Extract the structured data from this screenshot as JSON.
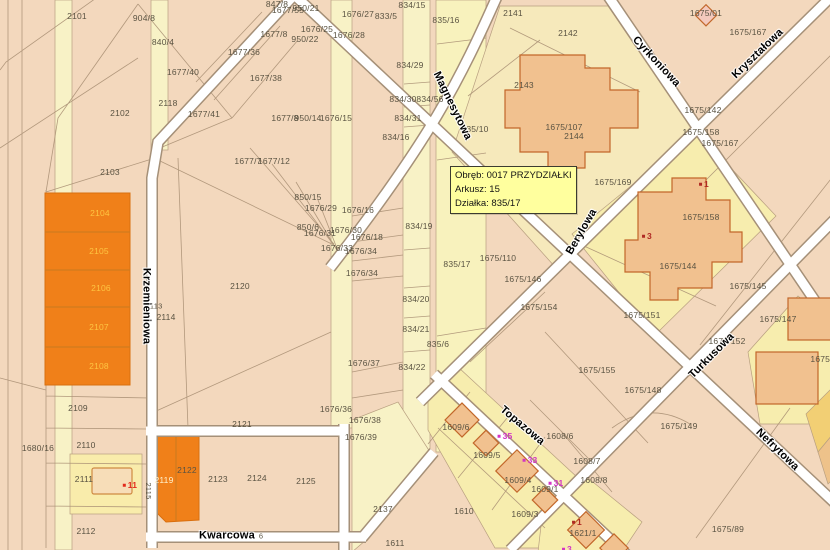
{
  "map": {
    "info_box": {
      "lines": [
        "Obręb: 0017 PRZYDZIAŁKI",
        "Arkusz: 15",
        "Działka: 835/17"
      ]
    },
    "colors": {
      "base": "#f3d8bd",
      "strip_yellow": "#f8f2c6",
      "parcel_yellow": "#f7edae",
      "orange": "#f08019",
      "street": "#ffffff",
      "building": "#f1c18f",
      "highlight_box": "#ffff9e"
    },
    "streets": [
      {
        "name": "Krzemieniowa",
        "x": 146,
        "y": 306,
        "rot": 90
      },
      {
        "name": "Kwarcowa",
        "x": 227,
        "y": 536,
        "rot": 0
      },
      {
        "name": "Magnesytowa",
        "x": 452,
        "y": 106,
        "rot": 64
      },
      {
        "name": "Cyrkoniowa",
        "x": 656,
        "y": 62,
        "rot": 47
      },
      {
        "name": "Kryształowa",
        "x": 758,
        "y": 54,
        "rot": -44
      },
      {
        "name": "Berylowa",
        "x": 582,
        "y": 232,
        "rot": -60
      },
      {
        "name": "Turkusowa",
        "x": 712,
        "y": 356,
        "rot": -45
      },
      {
        "name": "Topazowa",
        "x": 522,
        "y": 426,
        "rot": 40
      },
      {
        "name": "Nefrytowa",
        "x": 777,
        "y": 450,
        "rot": 44
      }
    ],
    "parcels": [
      {
        "t": "2101",
        "x": 77,
        "y": 16
      },
      {
        "t": "904/8",
        "x": 144,
        "y": 18
      },
      {
        "t": "840/4",
        "x": 163,
        "y": 42
      },
      {
        "t": "1677/40",
        "x": 183,
        "y": 72
      },
      {
        "t": "2118",
        "x": 168,
        "y": 103
      },
      {
        "t": "2102",
        "x": 120,
        "y": 113
      },
      {
        "t": "2103",
        "x": 110,
        "y": 172
      },
      {
        "t": "1677/41",
        "x": 204,
        "y": 114
      },
      {
        "t": "1677/36",
        "x": 244,
        "y": 52
      },
      {
        "t": "1677/38",
        "x": 266,
        "y": 78
      },
      {
        "t": "847/8",
        "x": 277,
        "y": 4
      },
      {
        "t": "1677/55",
        "x": 288,
        "y": 10
      },
      {
        "t": "950/21",
        "x": 306,
        "y": 8
      },
      {
        "t": "1676/27",
        "x": 358,
        "y": 14
      },
      {
        "t": "833/5",
        "x": 386,
        "y": 16
      },
      {
        "t": "1676/25",
        "x": 317,
        "y": 29
      },
      {
        "t": "1677/8",
        "x": 274,
        "y": 34
      },
      {
        "t": "950/22",
        "x": 305,
        "y": 39
      },
      {
        "t": "1676/28",
        "x": 349,
        "y": 35
      },
      {
        "t": "834/15",
        "x": 412,
        "y": 5
      },
      {
        "t": "835/16",
        "x": 446,
        "y": 20
      },
      {
        "t": "2141",
        "x": 513,
        "y": 13
      },
      {
        "t": "2142",
        "x": 568,
        "y": 33
      },
      {
        "t": "834/29",
        "x": 410,
        "y": 65
      },
      {
        "t": "2143",
        "x": 524,
        "y": 85
      },
      {
        "t": "834/30",
        "x": 403,
        "y": 99
      },
      {
        "t": "834/56",
        "x": 430,
        "y": 99
      },
      {
        "t": "834/31",
        "x": 408,
        "y": 118
      },
      {
        "t": "835/10",
        "x": 475,
        "y": 129
      },
      {
        "t": "1675/107",
        "x": 564,
        "y": 127
      },
      {
        "t": "2144",
        "x": 574,
        "y": 136
      },
      {
        "t": "834/16",
        "x": 396,
        "y": 137
      },
      {
        "t": "1675/01",
        "x": 706,
        "y": 13
      },
      {
        "t": "1675/167",
        "x": 748,
        "y": 32
      },
      {
        "t": "1675/142",
        "x": 703,
        "y": 110
      },
      {
        "t": "1675/158",
        "x": 701,
        "y": 132
      },
      {
        "t": "1675/167",
        "x": 720,
        "y": 143
      },
      {
        "t": "1675/169",
        "x": 613,
        "y": 182
      },
      {
        "t": "1675/158",
        "x": 701,
        "y": 217
      },
      {
        "t": "1675/144",
        "x": 678,
        "y": 266
      },
      {
        "t": "1675/145",
        "x": 748,
        "y": 286
      },
      {
        "t": "1677/7",
        "x": 248,
        "y": 161
      },
      {
        "t": "1677/12",
        "x": 274,
        "y": 161
      },
      {
        "t": "850/15",
        "x": 308,
        "y": 197
      },
      {
        "t": "1676/29",
        "x": 321,
        "y": 208
      },
      {
        "t": "1676/16",
        "x": 358,
        "y": 210
      },
      {
        "t": "850/6",
        "x": 308,
        "y": 227
      },
      {
        "t": "1676/31",
        "x": 320,
        "y": 233
      },
      {
        "t": "1676/30",
        "x": 346,
        "y": 230
      },
      {
        "t": "1676/18",
        "x": 367,
        "y": 237
      },
      {
        "t": "1676/33",
        "x": 337,
        "y": 248
      },
      {
        "t": "1676/34",
        "x": 361,
        "y": 251
      },
      {
        "t": "1676/34",
        "x": 362,
        "y": 273
      },
      {
        "t": "2120",
        "x": 240,
        "y": 286
      },
      {
        "t": "834/19",
        "x": 419,
        "y": 226
      },
      {
        "t": "835/17",
        "x": 457,
        "y": 264
      },
      {
        "t": "1675/110",
        "x": 498,
        "y": 258
      },
      {
        "t": "1675/146",
        "x": 523,
        "y": 279
      },
      {
        "t": "1675/154",
        "x": 539,
        "y": 307
      },
      {
        "t": "834/20",
        "x": 416,
        "y": 299
      },
      {
        "t": "834/21",
        "x": 416,
        "y": 329
      },
      {
        "t": "835/6",
        "x": 438,
        "y": 344
      },
      {
        "t": "2113",
        "x": 154,
        "y": 306,
        "c": "sm"
      },
      {
        "t": "2114",
        "x": 166,
        "y": 317
      },
      {
        "t": "1677/8",
        "x": 285,
        "y": 118
      },
      {
        "t": "950/14",
        "x": 308,
        "y": 118
      },
      {
        "t": "1676/15",
        "x": 336,
        "y": 118
      },
      {
        "t": "1675/151",
        "x": 642,
        "y": 315
      },
      {
        "t": "1675/147",
        "x": 778,
        "y": 319
      },
      {
        "t": "1675/152",
        "x": 727,
        "y": 341
      },
      {
        "t": "1675/155",
        "x": 597,
        "y": 370
      },
      {
        "t": "1675/148",
        "x": 643,
        "y": 390
      },
      {
        "t": "1675/8",
        "x": 824,
        "y": 359
      },
      {
        "t": "1676/37",
        "x": 364,
        "y": 363
      },
      {
        "t": "834/22",
        "x": 412,
        "y": 367
      },
      {
        "t": "1676/36",
        "x": 336,
        "y": 409
      },
      {
        "t": "1676/38",
        "x": 365,
        "y": 420
      },
      {
        "t": "1676/39",
        "x": 361,
        "y": 437
      },
      {
        "t": "2109",
        "x": 78,
        "y": 408
      },
      {
        "t": "1680/16",
        "x": 38,
        "y": 448
      },
      {
        "t": "2110",
        "x": 86,
        "y": 445
      },
      {
        "t": "2111",
        "x": 84,
        "y": 479
      },
      {
        "t": "2112",
        "x": 86,
        "y": 531
      },
      {
        "t": "2121",
        "x": 242,
        "y": 424
      },
      {
        "t": "2115",
        "x": 148,
        "y": 491,
        "r": 90,
        "c": "sm"
      },
      {
        "t": "2119",
        "x": 164,
        "y": 480,
        "c": "wh"
      },
      {
        "t": "2122",
        "x": 187,
        "y": 470
      },
      {
        "t": "2123",
        "x": 218,
        "y": 479
      },
      {
        "t": "2124",
        "x": 257,
        "y": 478
      },
      {
        "t": "2125",
        "x": 306,
        "y": 481
      },
      {
        "t": "2137",
        "x": 383,
        "y": 509
      },
      {
        "t": "1611",
        "x": 395,
        "y": 543
      },
      {
        "t": "1610",
        "x": 464,
        "y": 511
      },
      {
        "t": "1609/6",
        "x": 456,
        "y": 427
      },
      {
        "t": "1609/5",
        "x": 487,
        "y": 455
      },
      {
        "t": "1609/4",
        "x": 518,
        "y": 480
      },
      {
        "t": "1609/1",
        "x": 545,
        "y": 489
      },
      {
        "t": "1609/3",
        "x": 525,
        "y": 514
      },
      {
        "t": "1608/6",
        "x": 560,
        "y": 436
      },
      {
        "t": "1608/7",
        "x": 587,
        "y": 461
      },
      {
        "t": "1608/8",
        "x": 594,
        "y": 480
      },
      {
        "t": "1621/1",
        "x": 583,
        "y": 533
      },
      {
        "t": "1675/149",
        "x": 679,
        "y": 426
      },
      {
        "t": "1675/89",
        "x": 728,
        "y": 529
      },
      {
        "t": "6",
        "x": 261,
        "y": 536,
        "c": "sm"
      },
      {
        "t": "2104",
        "x": 100,
        "y": 213,
        "c": "or"
      },
      {
        "t": "2105",
        "x": 99,
        "y": 251,
        "c": "or"
      },
      {
        "t": "2106",
        "x": 101,
        "y": 288,
        "c": "or"
      },
      {
        "t": "2107",
        "x": 99,
        "y": 327,
        "c": "or"
      },
      {
        "t": "2108",
        "x": 99,
        "y": 366,
        "c": "or"
      }
    ],
    "addresses": [
      {
        "t": "1",
        "x": 704,
        "y": 184,
        "c": "dot"
      },
      {
        "t": "3",
        "x": 647,
        "y": 236,
        "c": "dot"
      },
      {
        "t": "11",
        "x": 130,
        "y": 485,
        "c": "red"
      },
      {
        "t": "35",
        "x": 505,
        "y": 436,
        "c": "mag"
      },
      {
        "t": "33",
        "x": 530,
        "y": 460,
        "c": "mag"
      },
      {
        "t": "31",
        "x": 556,
        "y": 483,
        "c": "mag"
      },
      {
        "t": "1",
        "x": 577,
        "y": 522,
        "c": "dot"
      },
      {
        "t": "3",
        "x": 567,
        "y": 549,
        "c": "mag"
      }
    ]
  }
}
